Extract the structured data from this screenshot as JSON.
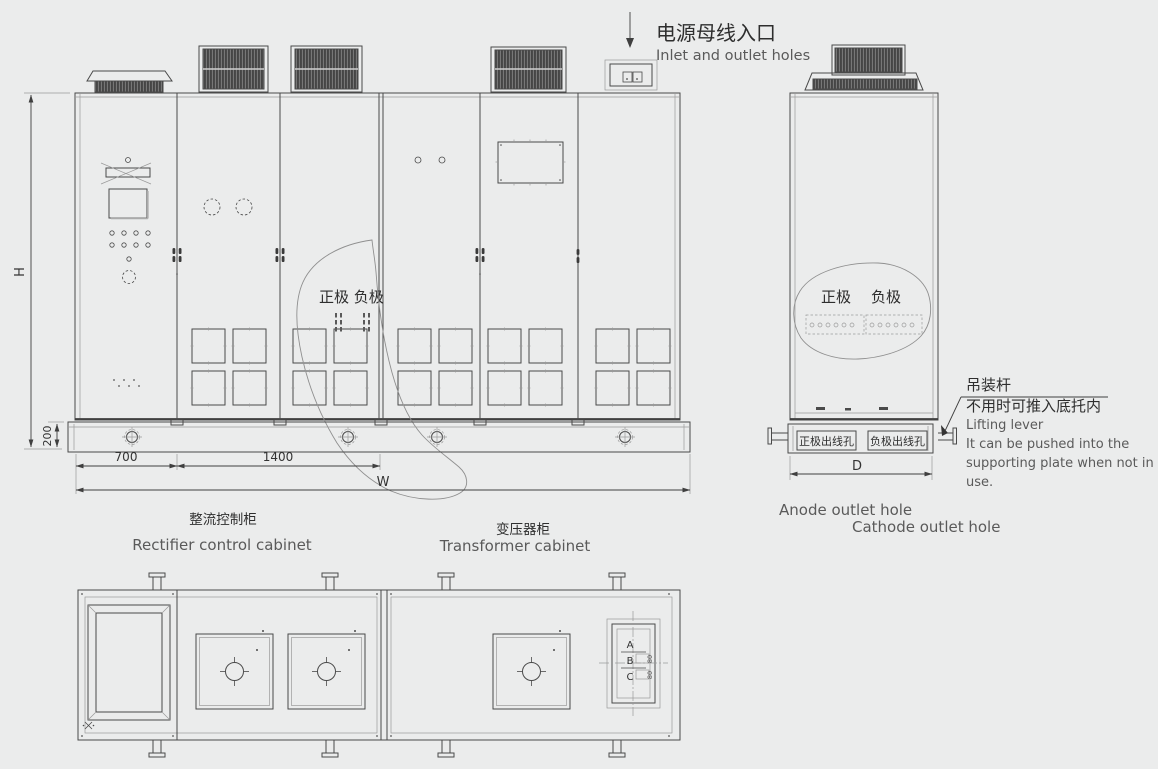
{
  "bus_inlet": {
    "zh": "电源母线入口",
    "en": "Inlet and outlet holes"
  },
  "front_view": {
    "polarity": "正极 负极",
    "dim_h": "H",
    "dim_base": "200",
    "dim_700": "700",
    "dim_1400": "1400",
    "dim_w": "W",
    "rectifier_label_zh": "整流控制柜",
    "rectifier_label_en": "Rectifier control cabinet",
    "transformer_label_zh": "变压器柜",
    "transformer_label_en": "Transformer cabinet"
  },
  "side_view": {
    "anode": "正极",
    "cathode": "负极",
    "anode_outlet_zh": "正极出线孔",
    "cathode_outlet_zh": "负极出线孔",
    "anode_outlet_en": "Anode outlet hole",
    "cathode_outlet_en": "Cathode outlet hole",
    "dim_d": "D",
    "lifting_zh_1": "吊装杆",
    "lifting_zh_2": "不用时可推入底托内",
    "lifting_en_1": "Lifting lever",
    "lifting_en_2": "It can be pushed into the",
    "lifting_en_3": "supporting plate when not in",
    "lifting_en_4": "use."
  },
  "plan_view": {
    "dim_a": "A",
    "dim_b": "B",
    "dim_c": "C",
    "dim_b_val": "80",
    "dim_c_val": "80"
  }
}
